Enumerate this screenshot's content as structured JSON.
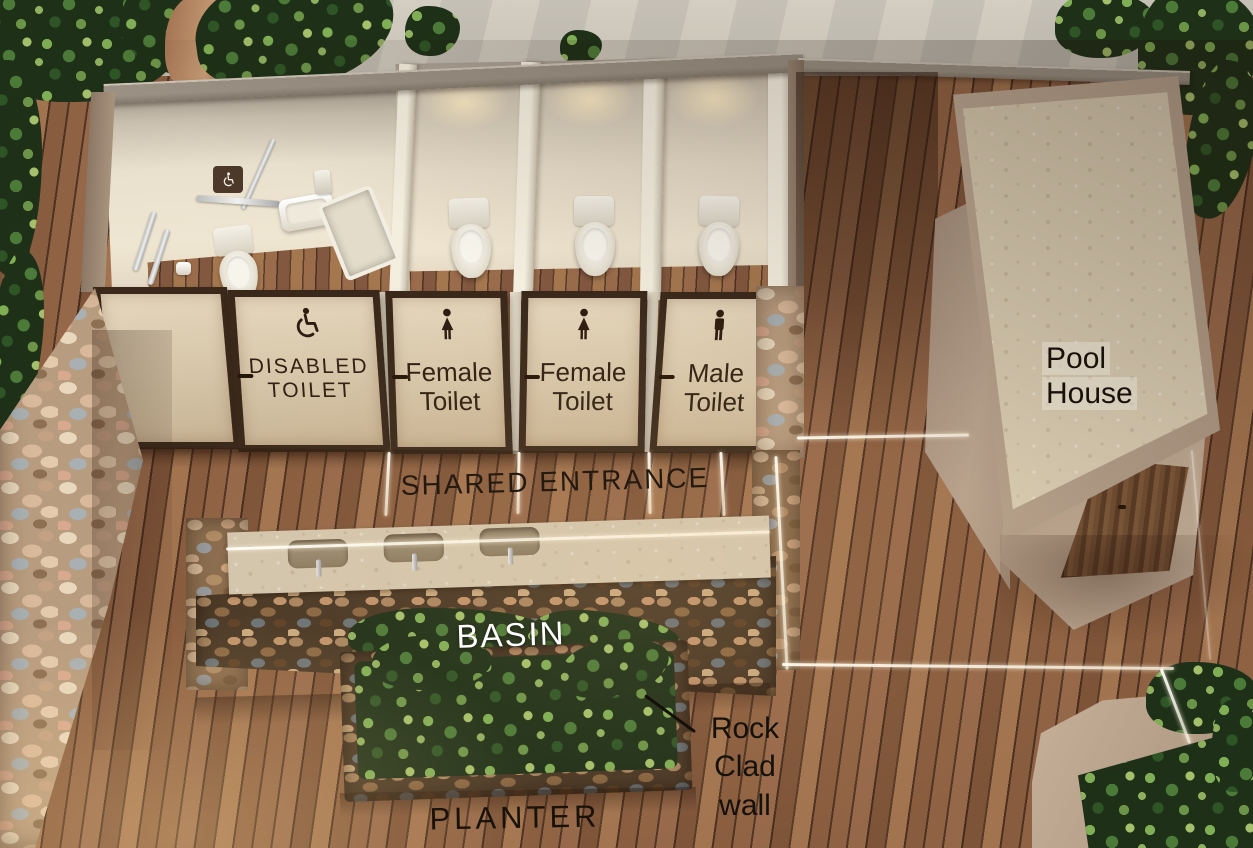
{
  "doors": [
    {
      "icon": "wheelchair-icon",
      "line1": "DISABLED",
      "line2": "TOILET"
    },
    {
      "icon": "female-icon",
      "line1": "Female",
      "line2": "Toilet"
    },
    {
      "icon": "female-icon",
      "line1": "Female",
      "line2": "Toilet"
    },
    {
      "icon": "male-icon",
      "line1": "Male",
      "line2": "Toilet"
    }
  ],
  "labels": {
    "shared_entrance": "SHARED ENTRANCE",
    "basin": "BASIN",
    "planter": "PLANTER",
    "rock_clad_wall": {
      "line1": "Rock",
      "line2": "Clad",
      "line3": "wall"
    },
    "pool_house": {
      "line1": "Pool",
      "line2": "House"
    }
  },
  "icons": [
    "wheelchair-icon",
    "female-icon",
    "male-icon",
    "accessible-sign-icon"
  ],
  "colors": {
    "deck_wood": "#8a5d3e",
    "wall_tan": "#a8937e",
    "interior_wall": "#e9e0cd",
    "door_cream": "#d9c9b0",
    "door_frame": "#3a291b",
    "rock_light": "#b89c7f",
    "rock_dark": "#4a3826",
    "stone_counter": "#d3c6ad",
    "foliage_green": "#4c7a38",
    "concrete_path": "#c8c1b4",
    "label_dark": "#1c140c",
    "label_white": "#ffffff",
    "icon_dark": "#2e1c10"
  }
}
